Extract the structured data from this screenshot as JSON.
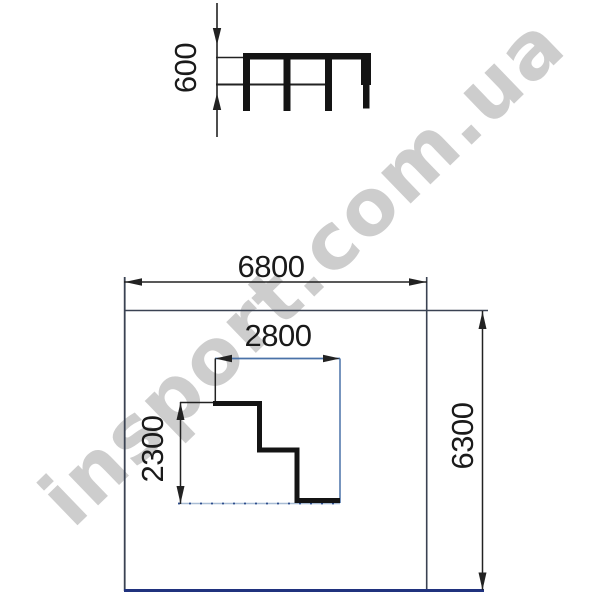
{
  "watermark": {
    "text": "insport.com.ua",
    "color": "#c9c9c9"
  },
  "views": {
    "elevation": {
      "height_label": "600"
    },
    "plan": {
      "safety_zone_width_label": "6800",
      "safety_zone_depth_label": "6300",
      "platform_width_label": "2800",
      "platform_depth_label": "2300"
    }
  },
  "colors": {
    "dim_line": "#222222",
    "outline_dark": "#3a4252",
    "structure_black": "#141414",
    "inner_blue": "#4a72a8",
    "dotted_blue": "#2c4c8c",
    "dotted_pale": "#a8bcd4",
    "bottom_navy": "#20327e"
  }
}
